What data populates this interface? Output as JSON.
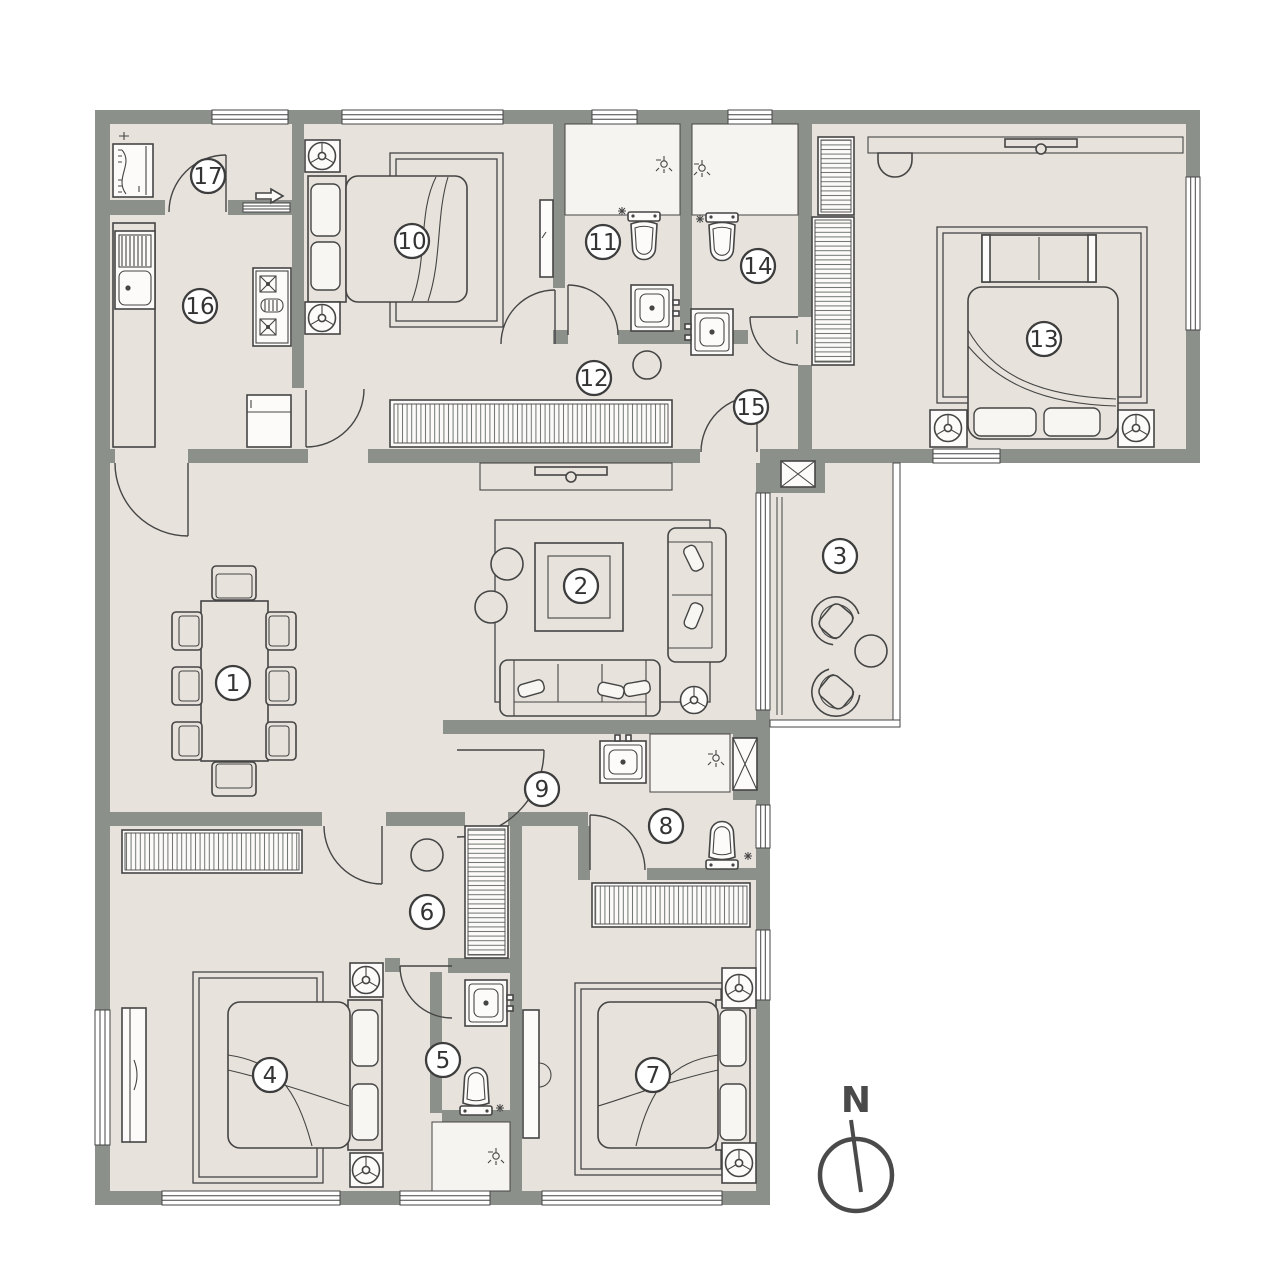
{
  "plan": {
    "colors": {
      "wall": "#8c908a",
      "floor": "#e7e3dc",
      "line": "#454545",
      "light": "#f6f4f0",
      "fixture": "#fcfbfa",
      "hatch": "#70746d"
    },
    "room_labels": [
      {
        "number": "1",
        "x": 233,
        "y": 683
      },
      {
        "number": "2",
        "x": 581,
        "y": 586
      },
      {
        "number": "3",
        "x": 840,
        "y": 556
      },
      {
        "number": "4",
        "x": 270,
        "y": 1075
      },
      {
        "number": "5",
        "x": 443,
        "y": 1060
      },
      {
        "number": "6",
        "x": 427,
        "y": 912
      },
      {
        "number": "7",
        "x": 653,
        "y": 1075
      },
      {
        "number": "8",
        "x": 666,
        "y": 826
      },
      {
        "number": "9",
        "x": 542,
        "y": 789
      },
      {
        "number": "10",
        "x": 412,
        "y": 241
      },
      {
        "number": "11",
        "x": 603,
        "y": 242
      },
      {
        "number": "12",
        "x": 594,
        "y": 378
      },
      {
        "number": "13",
        "x": 1044,
        "y": 339
      },
      {
        "number": "14",
        "x": 758,
        "y": 266
      },
      {
        "number": "15",
        "x": 751,
        "y": 407
      },
      {
        "number": "16",
        "x": 200,
        "y": 306
      },
      {
        "number": "17",
        "x": 208,
        "y": 176
      }
    ],
    "compass": {
      "label": "N",
      "cx": 856,
      "cy": 1175
    }
  }
}
